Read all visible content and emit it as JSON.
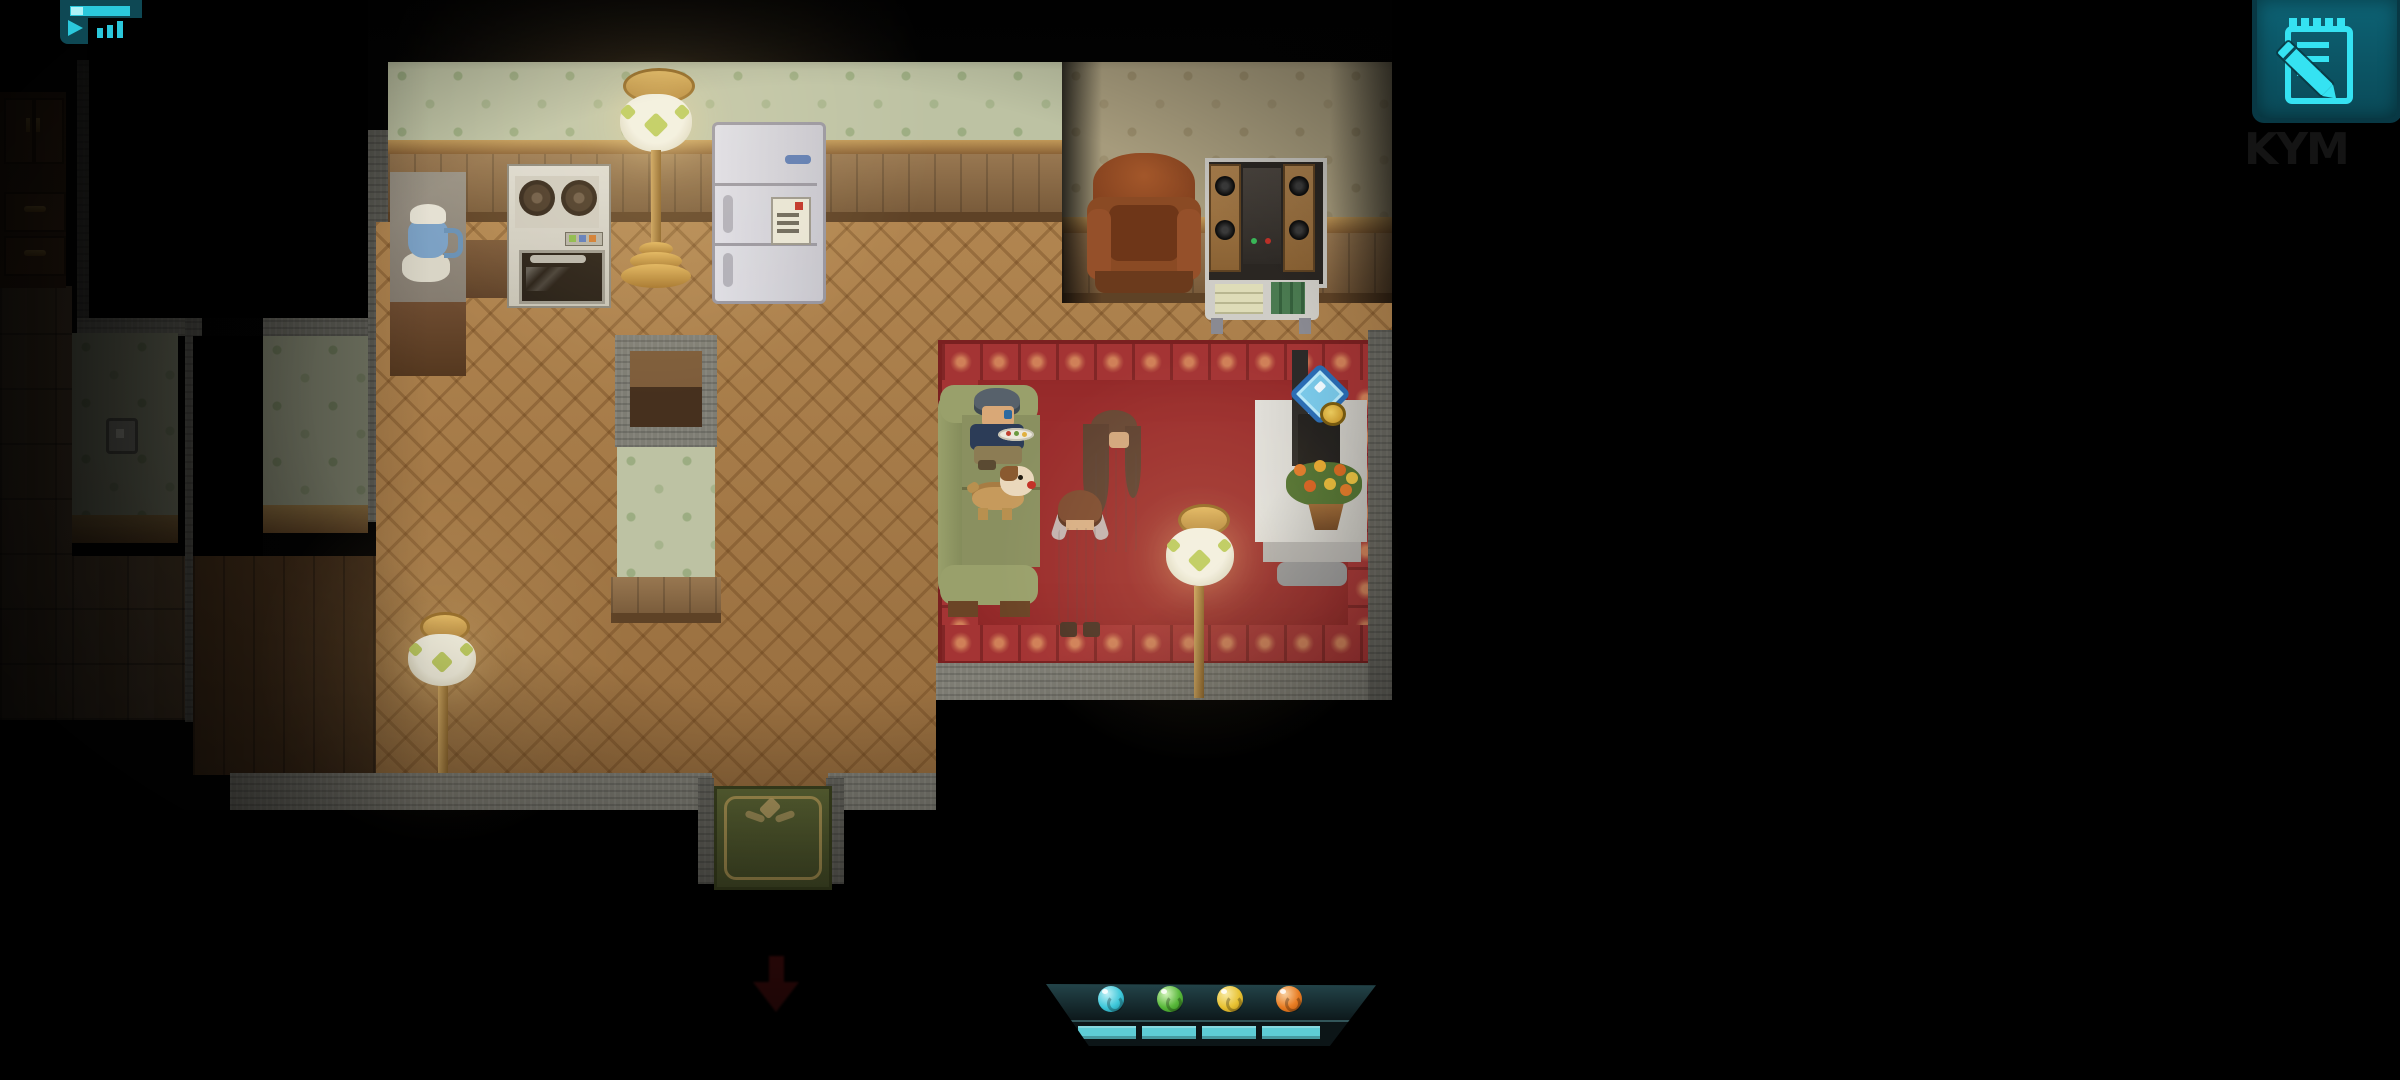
{
  "watermark": "KYM",
  "ui": {
    "top_left_icon": {
      "name": "media-player-indicator",
      "bg": "#0e4854",
      "glyph_color": "#2bc8dc",
      "parts": [
        "progress-bar",
        "play-triangle",
        "equalizer-bars"
      ]
    },
    "journal_button": {
      "name": "journal-notepad-button",
      "bg": "#0a505e",
      "glyph_color": "#35e2f2",
      "glyph": "notepad-with-pencil"
    },
    "down_arrow_indicator": {
      "color": "#511010",
      "direction": "down"
    },
    "hud": {
      "panel_bg": "#101e21",
      "orbs": [
        {
          "id": "cyan-orb",
          "color": "#3ec8da"
        },
        {
          "id": "green-orb",
          "color": "#58b83a"
        },
        {
          "id": "yellow-orb",
          "color": "#e8c232"
        },
        {
          "id": "orange-orb",
          "color": "#e87c22"
        }
      ],
      "bars": [
        {
          "for": "cyan-orb",
          "state": "full",
          "color": "#5ecdd6"
        },
        {
          "for": "green-orb",
          "state": "full",
          "color": "#5ecdd6"
        },
        {
          "for": "yellow-orb",
          "state": "full",
          "color": "#5ecdd6"
        },
        {
          "for": "orange-orb",
          "state": "full",
          "color": "#5ecdd6"
        }
      ]
    }
  },
  "scene": {
    "rooms": [
      "dim-left-hallway",
      "dark-room",
      "kitchen",
      "living-room"
    ],
    "kitchen_furniture": [
      "wooden-dresser",
      "counter-with-coffee-pot",
      "stove-oven",
      "floor-lamp",
      "refrigerator",
      "wall-niche",
      "south-floor-lamp",
      "green-doormat",
      "light-switch"
    ],
    "living_room_furniture": [
      "leather-armchair",
      "stereo-shelf",
      "green-couch",
      "red-carpet",
      "floor-lamp",
      "tv-side-table",
      "television",
      "flower-pot"
    ],
    "markers": [
      "sparkle-interaction-marker",
      "magnifier-badge"
    ],
    "characters": [
      {
        "id": "boy-on-couch",
        "desc": "boy with gray hair holding a plate, sitting on couch"
      },
      {
        "id": "dog",
        "desc": "tan dog with white muzzle lying on couch"
      },
      {
        "id": "woman",
        "desc": "long brown-haired woman in pale nightgown"
      },
      {
        "id": "child",
        "desc": "auburn-haired child in pajamas hugging the woman"
      }
    ]
  }
}
